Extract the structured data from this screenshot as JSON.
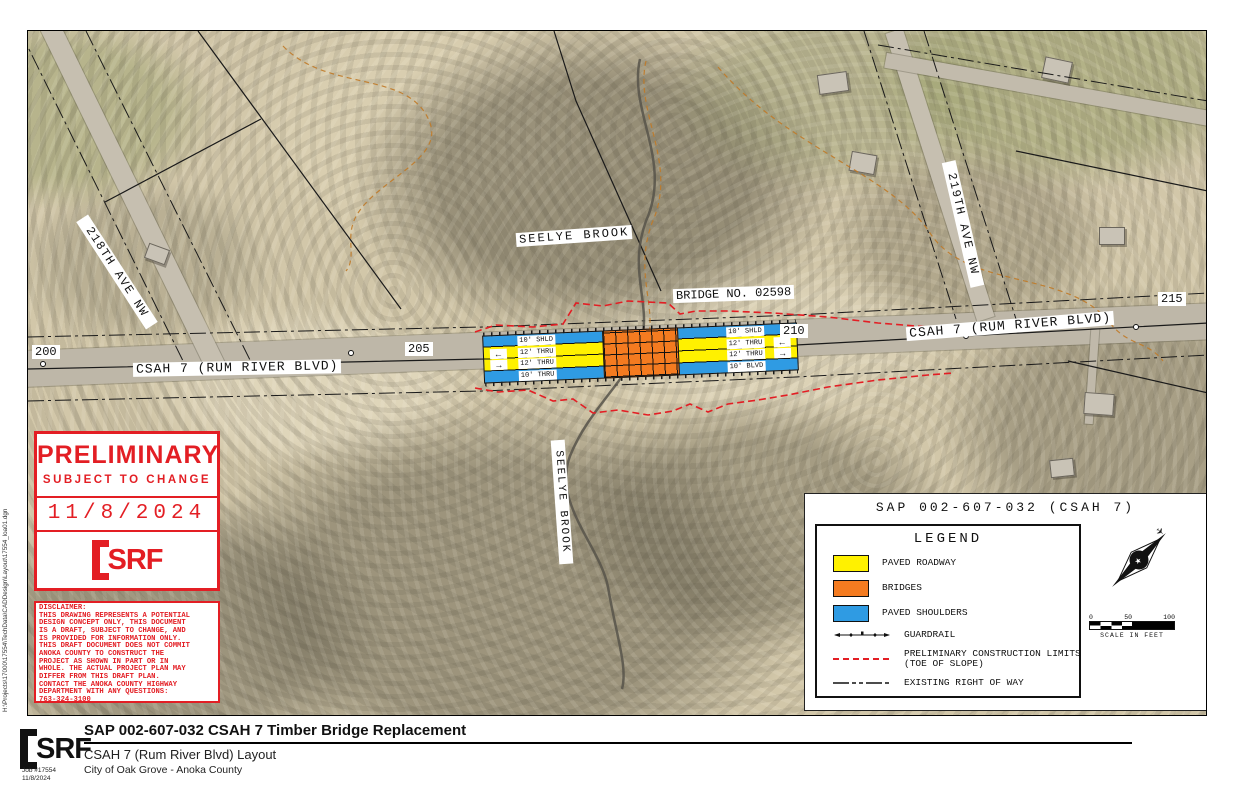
{
  "sheet": {
    "filepath": "H:\\Projects\\17000\\17554\\TechData\\CADDesign\\Layout\\17554_loa01.dgn"
  },
  "map": {
    "stations": [
      "200",
      "205",
      "210",
      "215"
    ],
    "labels": {
      "csah7_left": "CSAH 7 (RUM RIVER BLVD)",
      "csah7_right": "CSAH 7 (RUM RIVER BLVD)",
      "bridge_no": "BRIDGE NO. 02598",
      "seelye_top": "SEELYE BROOK",
      "seelye_bottom": "SEELYE BROOK",
      "ave_218": "218TH AVE NW",
      "ave_219": "219TH AVE NW"
    },
    "lanes_left": [
      "10' SHLD",
      "12' THRU",
      "12' THRU",
      "10' THRU"
    ],
    "lanes_right": [
      "10' SHLD",
      "12' THRU",
      "12' THRU",
      "10' BLVD"
    ],
    "arrow_left": "←",
    "arrow_right": "→"
  },
  "preliminary": {
    "title": "PRELIMINARY",
    "subtitle": "SUBJECT TO CHANGE",
    "date": "11/8/2024",
    "logo_text": "SRF"
  },
  "disclaimer": {
    "lines": [
      "DISCLAIMER:",
      "THIS DRAWING REPRESENTS A POTENTIAL",
      "DESIGN CONCEPT ONLY, THIS DOCUMENT",
      "IS A DRAFT, SUBJECT TO CHANGE, AND",
      "IS PROVIDED FOR INFORMATION ONLY.",
      "THIS DRAFT DOCUMENT DOES NOT COMMIT",
      "ANOKA COUNTY TO CONSTRUCT THE",
      "PROJECT AS SHOWN IN PART OR IN",
      "WHOLE. THE ACTUAL PROJECT PLAN MAY",
      "DIFFER FROM THIS DRAFT PLAN.",
      "CONTACT THE ANOKA COUNTY HIGHWAY",
      "DEPARTMENT WITH ANY QUESTIONS:",
      "763-324-3100"
    ]
  },
  "legend": {
    "panel_title": "SAP 002-607-032 (CSAH 7)",
    "heading": "LEGEND",
    "items": [
      {
        "label": "PAVED ROADWAY",
        "swatch": "#FFF100"
      },
      {
        "label": "BRIDGES",
        "swatch": "#F47B20"
      },
      {
        "label": "PAVED SHOULDERS",
        "swatch": "#2F9BE3"
      },
      {
        "label": "GUARDRAIL"
      },
      {
        "label": "PRELIMINARY CONSTRUCTION LIMITS",
        "label2": "(TOE OF SLOPE)",
        "color": "#E31E24"
      },
      {
        "label": "EXISTING RIGHT OF WAY"
      }
    ],
    "scale": {
      "ticks": [
        "0",
        "50",
        "100"
      ],
      "caption": "SCALE IN FEET"
    }
  },
  "titleblock": {
    "logo_text": "SRF",
    "job": "Job #17554",
    "date": "11/8/2024",
    "title": "SAP 002-607-032 CSAH 7 Timber Bridge Replacement",
    "subtitle": "CSAH 7 (Rum River Blvd) Layout",
    "client": "City of Oak Grove - Anoka County"
  }
}
